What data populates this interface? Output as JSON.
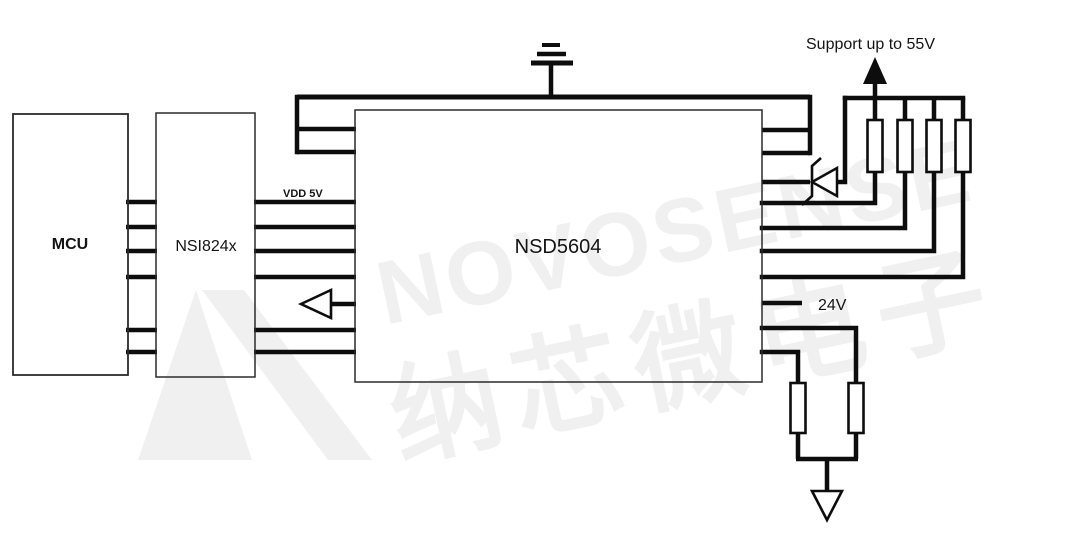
{
  "diagram": {
    "title_blocks": {
      "mcu": "MCU",
      "isolator": "NSI824x",
      "driver": "NSD5604"
    },
    "labels": {
      "vdd": "VDD 5V",
      "rail_24v": "24V",
      "support": "Support up to 55V"
    },
    "watermark": {
      "brand": "NOVOSENSE",
      "brand_cn": "纳芯微电子"
    },
    "icons": [
      "earth-ground-icon",
      "supply-arrow-icon",
      "zener-diode-icon",
      "resistor",
      "signal-ground-icon",
      "feedback-arrow-icon"
    ],
    "colors": {
      "wire": "#0d0d0d",
      "box_border": "#2b2b2b",
      "watermark": "#f0f0f0",
      "background": "#ffffff"
    }
  }
}
